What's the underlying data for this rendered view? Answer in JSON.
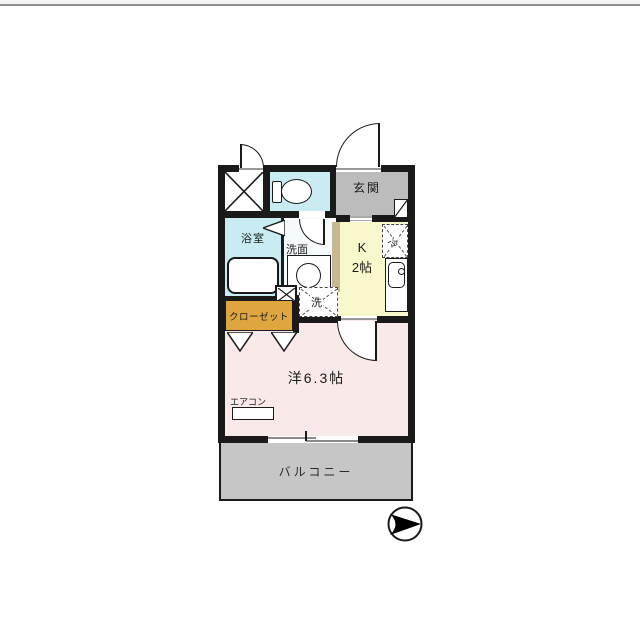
{
  "page": {
    "type": "real-estate-floorplan",
    "top_rule_color": "#8f8f8f"
  },
  "labels": {
    "entrance": "玄関",
    "bathroom": "浴室",
    "washroom": "洗面",
    "kitchen_line1": "K",
    "kitchen_line2": "2帖",
    "fridge": "冷",
    "laundry": "洗",
    "closet": "クローゼット",
    "main_room": "洋6.3帖",
    "aircon": "エアコン",
    "balcony": "バルコニー"
  },
  "colors": {
    "wall": "#1a1a1a",
    "wet_area_cyan": "#c8ecf2",
    "entrance_gray": "#bcbcbc",
    "kitchen_yellow": "#f9f8cc",
    "room_pink": "#fae9e9",
    "closet_orange": "#dfa640",
    "balcony_gray": "#c6c6c6",
    "partition_tan": "#c8b98e"
  },
  "compass": {
    "icon": "north-arrow",
    "direction": "right"
  }
}
